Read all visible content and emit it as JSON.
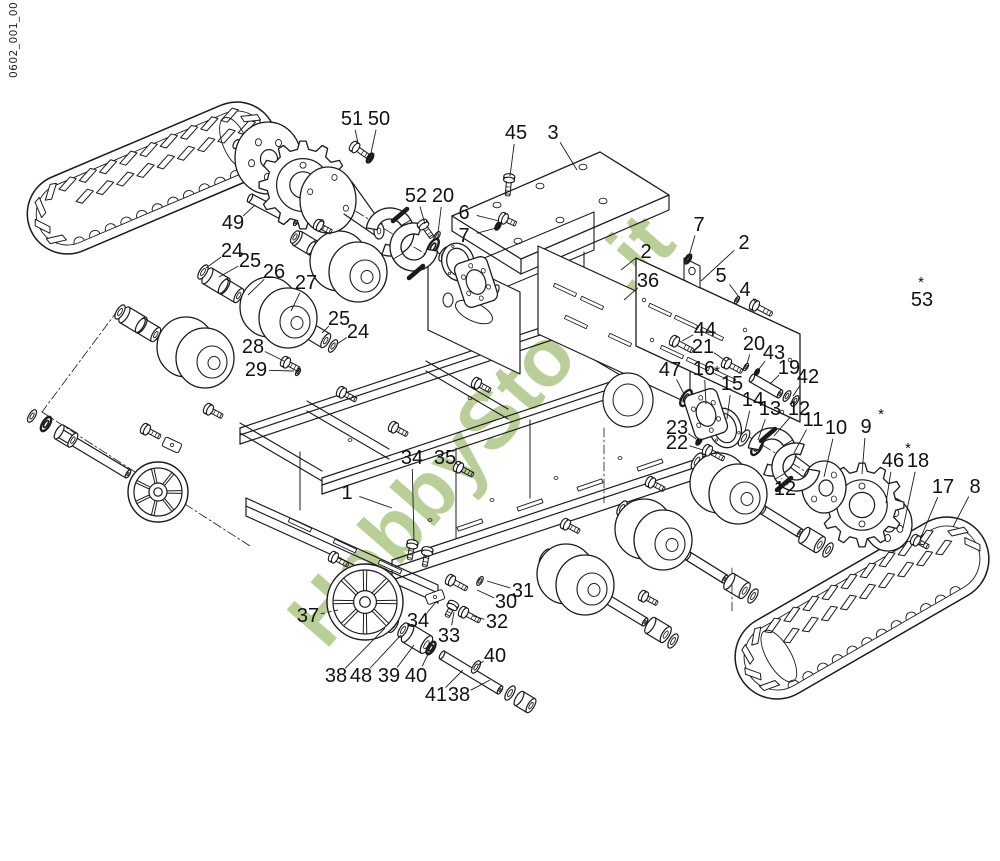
{
  "doc": {
    "number": "0602_001_00"
  },
  "watermark": {
    "text": "HobbyStore.it",
    "color": "#b9cf97"
  },
  "diagram": {
    "type": "exploded-parts-diagram",
    "line_color": "#1b1b1b",
    "background": "#ffffff",
    "components": [
      "left rubber track",
      "right rubber track",
      "chassis frame",
      "drive sprockets",
      "flanged hubs",
      "track rollers",
      "idler wheels",
      "brake shoes",
      "axles",
      "bushings",
      "washers",
      "bolts",
      "gearbox mounting plates"
    ],
    "callouts": [
      {
        "label": "51",
        "x": 352,
        "y": 119,
        "tx": 358,
        "ty": 143
      },
      {
        "label": "50",
        "x": 379,
        "y": 119,
        "tx": 371,
        "ty": 153
      },
      {
        "label": "45",
        "x": 516,
        "y": 133,
        "tx": 510,
        "ty": 176
      },
      {
        "label": "3",
        "x": 553,
        "y": 133,
        "tx": 577,
        "ty": 170
      },
      {
        "label": "52",
        "x": 416,
        "y": 196,
        "tx": 425,
        "ty": 224
      },
      {
        "label": "20",
        "x": 443,
        "y": 196,
        "tx": 438,
        "ty": 233
      },
      {
        "label": "6",
        "x": 464,
        "y": 213,
        "tx": 499,
        "ty": 221
      },
      {
        "label": "7",
        "x": 464,
        "y": 236,
        "tx": 500,
        "ty": 227
      },
      {
        "label": "49",
        "x": 233,
        "y": 223,
        "tx": 255,
        "ty": 205
      },
      {
        "label": "24",
        "x": 232,
        "y": 251,
        "tx": 206,
        "ty": 268
      },
      {
        "label": "25",
        "x": 250,
        "y": 261,
        "tx": 219,
        "ty": 277
      },
      {
        "label": "26",
        "x": 274,
        "y": 272,
        "tx": 248,
        "ty": 295
      },
      {
        "label": "27",
        "x": 306,
        "y": 283,
        "tx": 291,
        "ty": 311
      },
      {
        "label": "25",
        "x": 339,
        "y": 319,
        "tx": 322,
        "ty": 333
      },
      {
        "label": "24",
        "x": 358,
        "y": 332,
        "tx": 337,
        "ty": 344
      },
      {
        "label": "28",
        "x": 253,
        "y": 347,
        "tx": 284,
        "ty": 361
      },
      {
        "label": "29",
        "x": 256,
        "y": 370,
        "tx": 294,
        "ty": 371
      },
      {
        "label": "7",
        "x": 699,
        "y": 225,
        "tx": 689,
        "ty": 256
      },
      {
        "label": "2",
        "x": 744,
        "y": 243,
        "tx": 701,
        "ty": 281
      },
      {
        "label": "2",
        "x": 646,
        "y": 252,
        "tx": 621,
        "ty": 270
      },
      {
        "label": "5",
        "x": 721,
        "y": 276,
        "tx": 739,
        "ty": 297
      },
      {
        "label": "4",
        "x": 745,
        "y": 290,
        "tx": 756,
        "ty": 303
      },
      {
        "label": "36",
        "x": 648,
        "y": 281,
        "tx": 624,
        "ty": 300
      },
      {
        "label": "44",
        "x": 705,
        "y": 330,
        "tx": 682,
        "ty": 341
      },
      {
        "label": "21",
        "x": 703,
        "y": 347,
        "tx": 726,
        "ty": 361
      },
      {
        "label": "20",
        "x": 754,
        "y": 344,
        "tx": 747,
        "ty": 364
      },
      {
        "label": "43",
        "x": 774,
        "y": 353,
        "tx": 759,
        "ty": 369
      },
      {
        "label": "19",
        "x": 789,
        "y": 368,
        "tx": 770,
        "ty": 384
      },
      {
        "label": "42",
        "x": 808,
        "y": 377,
        "tx": 793,
        "ty": 396
      },
      {
        "label": "47",
        "x": 670,
        "y": 370,
        "tx": 684,
        "ty": 394
      },
      {
        "label": "16",
        "x": 704,
        "y": 369,
        "tx": 706,
        "ty": 404
      },
      {
        "label": "15",
        "x": 732,
        "y": 384,
        "ast": "before",
        "tx": 727,
        "ty": 419
      },
      {
        "label": "14",
        "x": 753,
        "y": 400,
        "tx": 745,
        "ty": 431
      },
      {
        "label": "13",
        "x": 770,
        "y": 409,
        "tx": 758,
        "ty": 440
      },
      {
        "label": "12",
        "x": 799,
        "y": 409,
        "tx": 774,
        "ty": 436
      },
      {
        "label": "11",
        "x": 813,
        "y": 420,
        "tx": 794,
        "ty": 453
      },
      {
        "label": "10",
        "x": 836,
        "y": 428,
        "tx": 824,
        "ty": 477
      },
      {
        "label": "9",
        "x": 866,
        "y": 427,
        "ast": "after",
        "tx": 862,
        "ty": 474
      },
      {
        "label": "53",
        "x": 922,
        "y": 300,
        "ast": "above"
      },
      {
        "label": "46",
        "x": 893,
        "y": 461,
        "ast": "after",
        "tx": 886,
        "ty": 503
      },
      {
        "label": "18",
        "x": 918,
        "y": 461,
        "tx": 903,
        "ty": 528
      },
      {
        "label": "17",
        "x": 943,
        "y": 487,
        "tx": 921,
        "ty": 537
      },
      {
        "label": "8",
        "x": 975,
        "y": 487,
        "tx": 953,
        "ty": 527
      },
      {
        "label": "23",
        "x": 677,
        "y": 428,
        "tx": 696,
        "ty": 439
      },
      {
        "label": "22",
        "x": 677,
        "y": 443,
        "tx": 703,
        "ty": 450
      },
      {
        "label": "12",
        "x": 785,
        "y": 489,
        "tx": 782,
        "ty": 479
      },
      {
        "label": "34",
        "x": 412,
        "y": 458,
        "tx": 414,
        "ty": 541
      },
      {
        "label": "35",
        "x": 445,
        "y": 458,
        "tx": 459,
        "ty": 466
      },
      {
        "label": "1",
        "x": 347,
        "y": 493,
        "tx": 392,
        "ty": 508
      },
      {
        "label": "37",
        "x": 308,
        "y": 616,
        "tx": 338,
        "ty": 610,
        "dash": true
      },
      {
        "label": "38",
        "x": 336,
        "y": 676,
        "tx": 385,
        "ty": 628
      },
      {
        "label": "48",
        "x": 361,
        "y": 676,
        "tx": 401,
        "ty": 635
      },
      {
        "label": "39",
        "x": 389,
        "y": 676,
        "tx": 414,
        "ty": 645
      },
      {
        "label": "40",
        "x": 416,
        "y": 676,
        "tx": 429,
        "ty": 652
      },
      {
        "label": "40",
        "x": 495,
        "y": 656,
        "tx": 478,
        "ty": 665
      },
      {
        "label": "41",
        "x": 436,
        "y": 695,
        "tx": 463,
        "ty": 670
      },
      {
        "label": "38",
        "x": 459,
        "y": 695,
        "tx": 490,
        "ty": 680
      },
      {
        "label": "34",
        "x": 418,
        "y": 621,
        "tx": 436,
        "ty": 602
      },
      {
        "label": "33",
        "x": 449,
        "y": 636,
        "tx": 454,
        "ty": 612
      },
      {
        "label": "32",
        "x": 497,
        "y": 622,
        "tx": 473,
        "ty": 616
      },
      {
        "label": "30",
        "x": 506,
        "y": 602,
        "tx": 477,
        "ty": 590
      },
      {
        "label": "31",
        "x": 523,
        "y": 591,
        "tx": 487,
        "ty": 581
      }
    ]
  }
}
